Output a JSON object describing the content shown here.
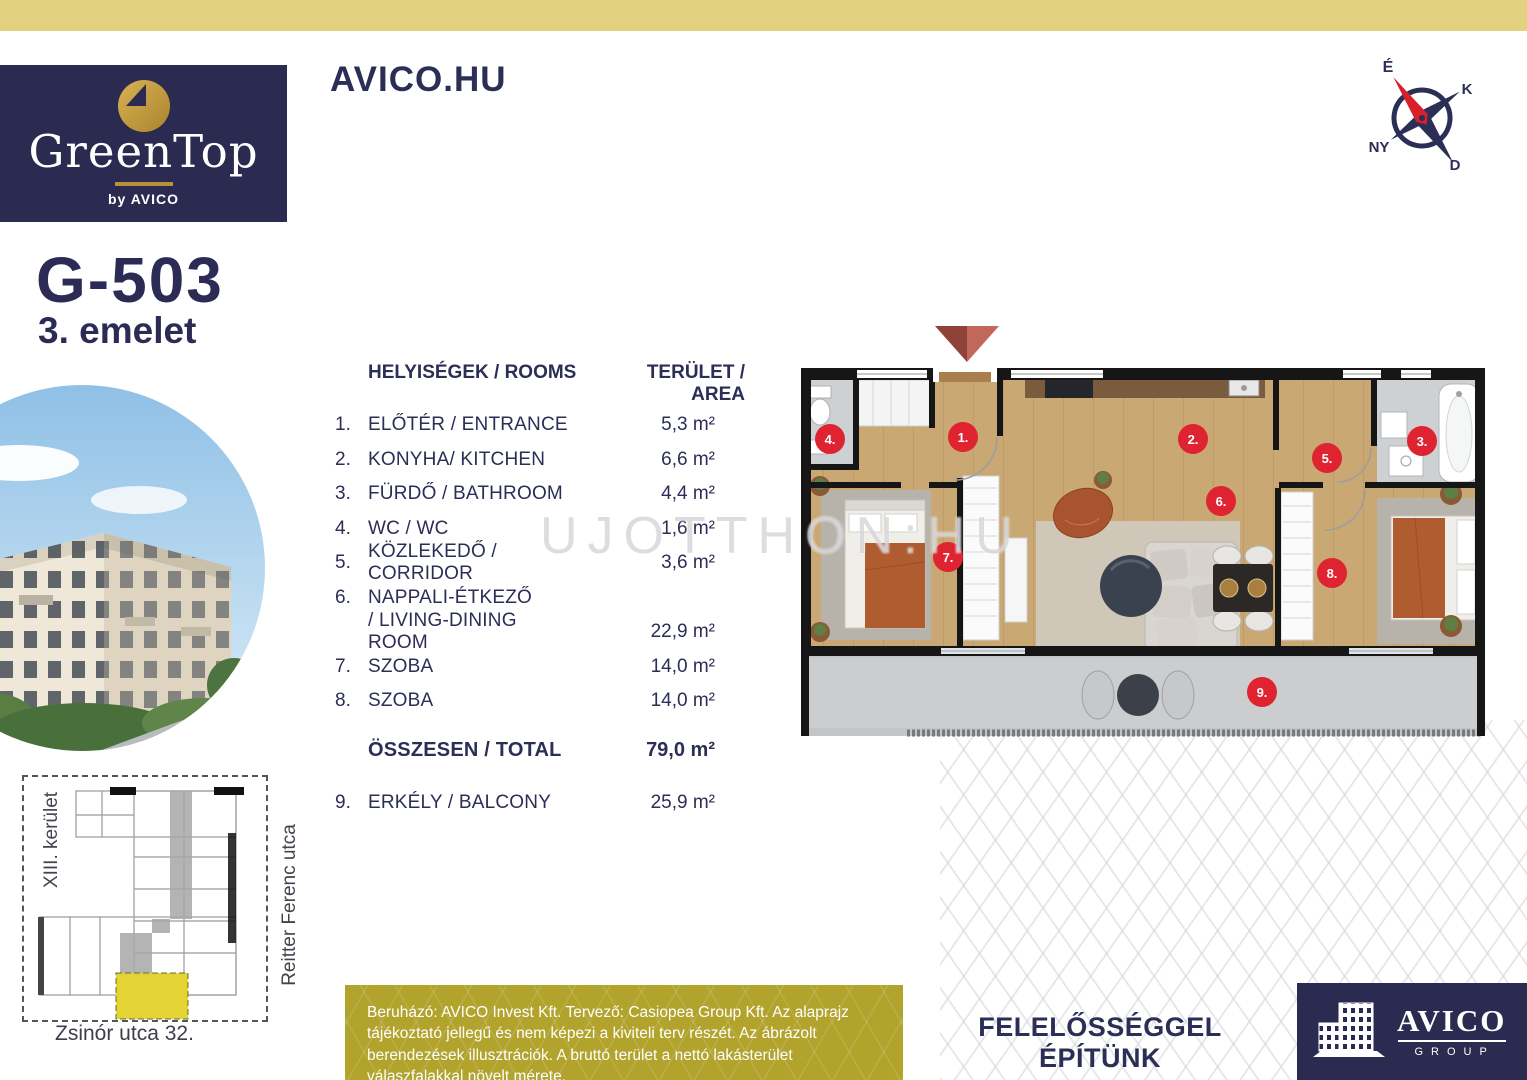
{
  "colors": {
    "accent_gold": "#e2d17e",
    "navy": "#2b2a50",
    "text_navy": "#2b2e55",
    "badge_red": "#e02330",
    "olive_box": "#b2a32c",
    "wood_floor": "#c9a873",
    "highlight_yellow": "#e3d334"
  },
  "header": {
    "site_url": "AVICO.HU"
  },
  "logo": {
    "brand": "GreenTop",
    "byline": "by AVICO"
  },
  "compass": {
    "n": "É",
    "e": "K",
    "s": "D",
    "w": "NY"
  },
  "unit": {
    "code": "G-503",
    "floor": "3. emelet"
  },
  "rooms_table": {
    "col_rooms": "HELYISÉGEK / ROOMS",
    "col_area": "TERÜLET / AREA",
    "rows": [
      {
        "num": "1.",
        "name": "ELŐTÉR / ENTRANCE",
        "area": "5,3 m²"
      },
      {
        "num": "2.",
        "name": "KONYHA/ KITCHEN",
        "area": "6,6 m²"
      },
      {
        "num": "3.",
        "name": "FÜRDŐ / BATHROOM",
        "area": "4,4 m²"
      },
      {
        "num": "4.",
        "name": "WC / WC",
        "area": "1,6 m²"
      },
      {
        "num": "5.",
        "name": "KÖZLEKEDŐ / CORRIDOR",
        "area": "3,6 m²"
      },
      {
        "num": "6.",
        "name": "NAPPALI-ÉTKEZŐ",
        "area": ""
      },
      {
        "num": "",
        "name": "/ LIVING-DINING ROOM",
        "area": "22,9 m²"
      },
      {
        "num": "7.",
        "name": "SZOBA",
        "area": "14,0 m²"
      },
      {
        "num": "8.",
        "name": "SZOBA",
        "area": "14,0 m²"
      }
    ],
    "total": {
      "label": "ÖSSZESEN / TOTAL",
      "area": "79,0 m²"
    },
    "balcony": {
      "num": "9.",
      "name": "ERKÉLY / BALCONY",
      "area": "25,9 m²"
    }
  },
  "watermark": "UJOTTHON:HU",
  "floorplan": {
    "badges": [
      "1.",
      "2.",
      "3.",
      "4.",
      "5.",
      "6.",
      "7.",
      "8.",
      "9."
    ]
  },
  "site_plan": {
    "district": "XIII. kerület",
    "street": "Reitter Ferenc utca",
    "address": "Zsinór utca 32."
  },
  "footer": {
    "disclaimer": "Beruházó: AVICO Invest Kft. Tervező: Casiopea Group Kft. Az alaprajz tájékoztató jellegű és nem képezi a kiviteli terv részét. Az ábrázolt berendezések illusztrációk. A bruttó terület a nettó lakásterület válaszfalakkal növelt mérete.",
    "slogan": "FELELŐSSÉGGEL ÉPÍTÜNK",
    "brand": "AVICO",
    "brand_sub": "GROUP"
  }
}
